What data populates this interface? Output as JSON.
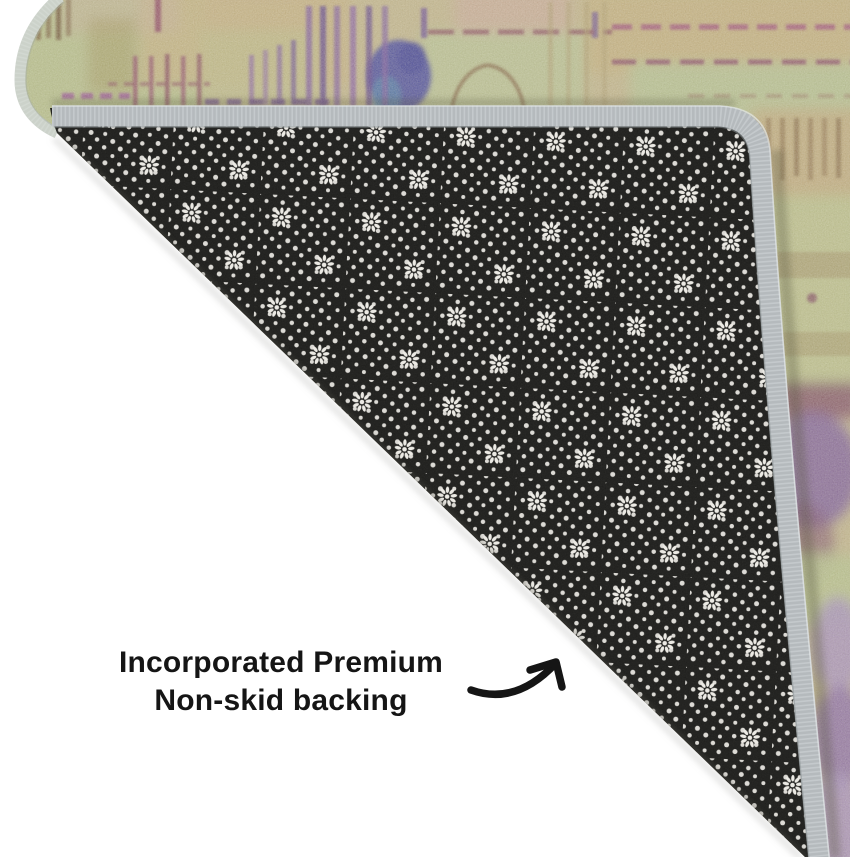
{
  "caption": {
    "line1": "Incorporated Premium",
    "line2": "Non-skid backing"
  },
  "scene": {
    "subject": "area rug corner folded over to reveal its non-skid backing",
    "backing_pattern": "grid of small white dots with flower-burst motifs",
    "rug_pattern": "distressed abstract in green, tan and purple"
  },
  "colors": {
    "floor": "#ffffff",
    "text": "#151515",
    "arrow": "#151515",
    "backing_base": "#1c1c1a",
    "backing_dot": "#eceae4",
    "binding_gray": "#b5babd",
    "binding_light": "#d8dcdd",
    "rug_edge_gray": "#ccd2ca",
    "rug_tan": "#c6b88e",
    "rug_green": "#b9c28d",
    "rug_purple": "#7e58a2",
    "rug_blue": "#4a4aa0",
    "rug_maroon": "#8e4a66",
    "rug_lavender": "#a88fc2"
  }
}
